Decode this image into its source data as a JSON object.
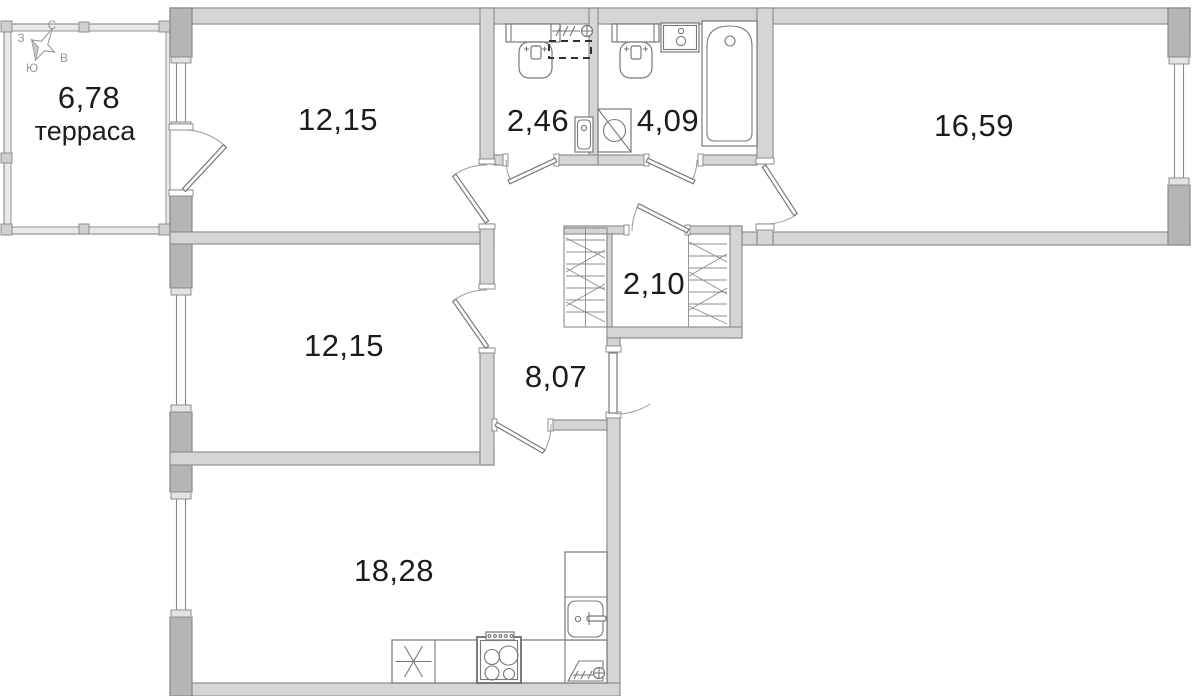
{
  "plan": {
    "title": "apartment floor plan",
    "compass": {
      "north": "С",
      "south": "Ю",
      "west": "З",
      "east": "В"
    },
    "rooms": [
      {
        "id": "terrace",
        "area": "6,78",
        "name": "терраса"
      },
      {
        "id": "bedroom-top",
        "area": "12,15",
        "name": ""
      },
      {
        "id": "wc-small",
        "area": "2,46",
        "name": ""
      },
      {
        "id": "bathroom",
        "area": "4,09",
        "name": ""
      },
      {
        "id": "room-large",
        "area": "16,59",
        "name": ""
      },
      {
        "id": "bedroom-middle",
        "area": "12,15",
        "name": ""
      },
      {
        "id": "wardrobe",
        "area": "2,10",
        "name": ""
      },
      {
        "id": "hallway",
        "area": "8,07",
        "name": ""
      },
      {
        "id": "kitchen-living",
        "area": "18,28",
        "name": ""
      }
    ],
    "fixtures": [
      "toilet",
      "towel-radiator",
      "boiler-dashed",
      "hand-sink",
      "toilet",
      "vanity-sink",
      "bathtub",
      "washing-machine",
      "fridge",
      "stove",
      "kitchen-sink",
      "radiator",
      "wardrobe-rails"
    ],
    "colors": {
      "wall": "#d5d5d5",
      "wall_dark": "#b5b5b5",
      "stroke": "#8f8f8f",
      "fixture": "#787878",
      "text": "#1c1c1e",
      "compass_text": "#97979a",
      "background": "#ffffff"
    }
  }
}
